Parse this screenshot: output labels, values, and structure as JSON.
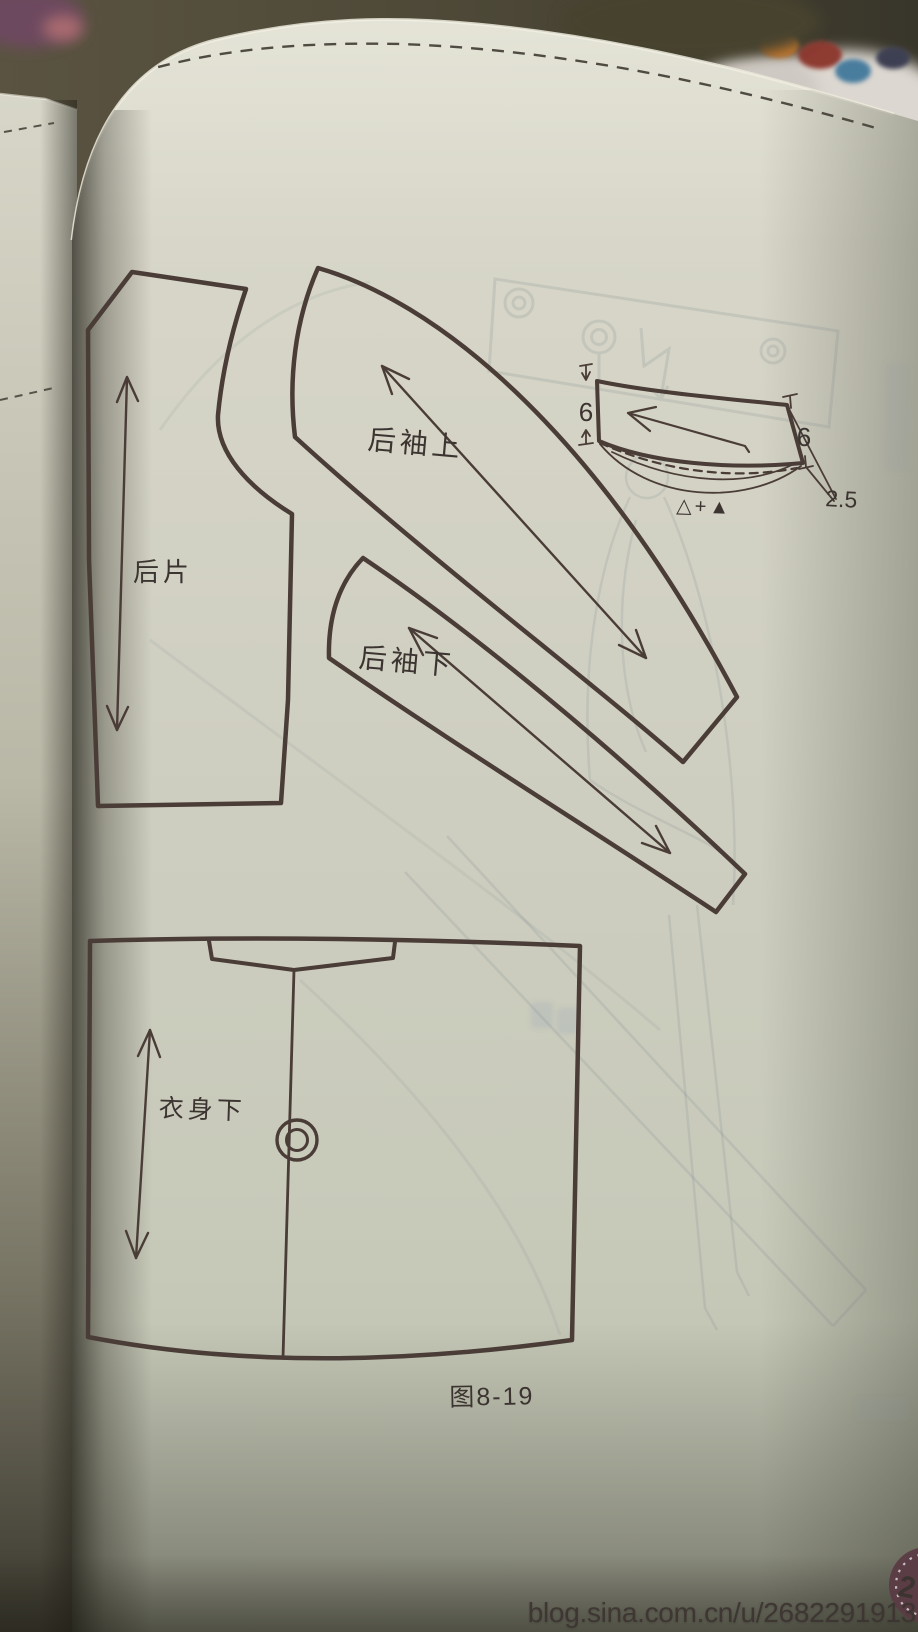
{
  "figure": {
    "labels": {
      "back_piece": "后片",
      "sleeve_upper_back": "后袖上",
      "sleeve_lower_back": "后袖下",
      "body_lower": "衣身下"
    },
    "caption": "图8-19",
    "collar_detail": {
      "dim_left": "6",
      "dim_right": "6",
      "dim_offset": "2.5",
      "formula": "△+▲"
    }
  },
  "watermark": {
    "text": "blog.sina.com.cn/u/2682291913"
  },
  "page_badge": {
    "number": "2"
  },
  "colors": {
    "paper": "#d2d1c3",
    "pattern_line": "#4a3c37",
    "ink": "#3c3431",
    "background": "#514b3b",
    "ghost_ink": "#7d8a96",
    "watermark_text": "#ffffff",
    "badge_fill": "#5b3b45"
  }
}
